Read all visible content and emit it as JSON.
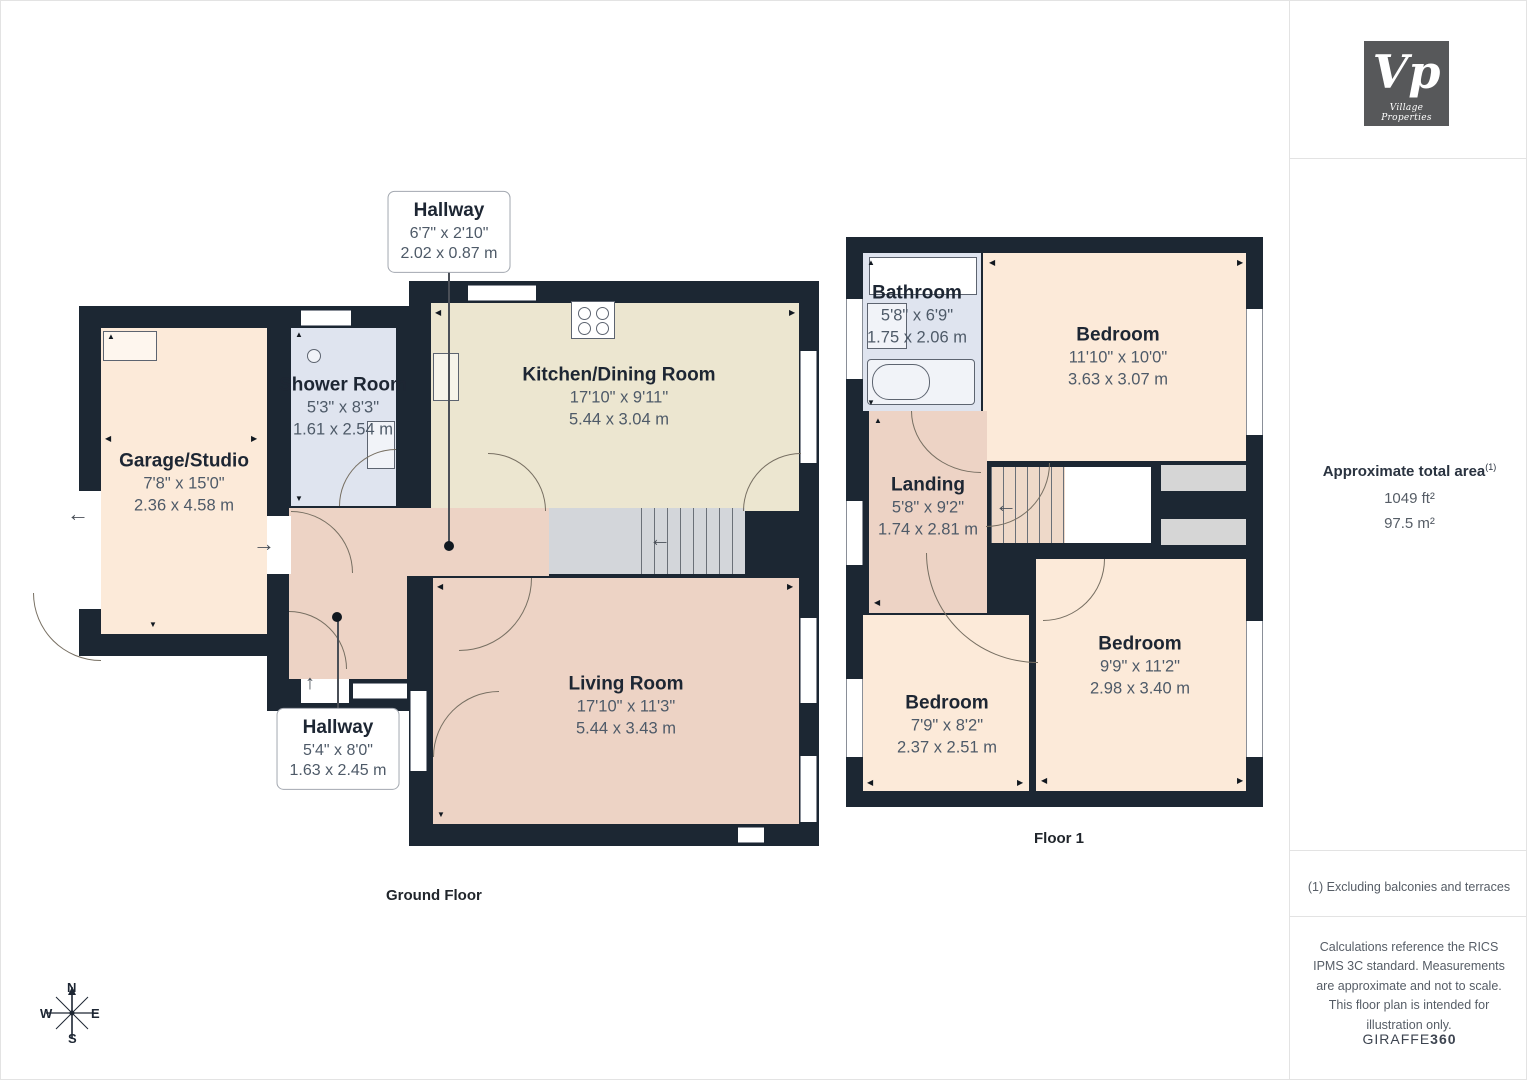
{
  "branding": {
    "logo_text": "Vp",
    "logo_caption": "Village Properties"
  },
  "sidebar": {
    "area_title": "Approximate total area",
    "area_sup": "(1)",
    "area_ft": "1049 ft²",
    "area_m": "97.5 m²",
    "footnote": "(1) Excluding balconies and terraces",
    "disclaimer": "Calculations reference the RICS IPMS 3C standard. Measurements are approximate and not to scale. This floor plan is intended for illustration only.",
    "brand_regular": "GIRAFFE",
    "brand_bold": "360"
  },
  "floors": {
    "ground": {
      "label": "Ground Floor",
      "rooms": [
        {
          "name": "Garage/Studio",
          "dims_imperial": "7'8\" x 15'0\"",
          "dims_metric": "2.36 x 4.58 m"
        },
        {
          "name": "Shower Room",
          "dims_imperial": "5'3\" x 8'3\"",
          "dims_metric": "1.61 x 2.54 m"
        },
        {
          "name": "Kitchen/Dining Room",
          "dims_imperial": "17'10\" x 9'11\"",
          "dims_metric": "5.44 x 3.04 m"
        },
        {
          "name": "Living Room",
          "dims_imperial": "17'10\" x 11'3\"",
          "dims_metric": "5.44 x 3.43 m"
        }
      ],
      "callouts": [
        {
          "name": "Hallway",
          "dims_imperial": "6'7\" x 2'10\"",
          "dims_metric": "2.02 x 0.87 m"
        },
        {
          "name": "Hallway",
          "dims_imperial": "5'4\" x 8'0\"",
          "dims_metric": "1.63 x 2.45 m"
        }
      ]
    },
    "floor1": {
      "label": "Floor 1",
      "rooms": [
        {
          "name": "Bathroom",
          "dims_imperial": "5'8\" x 6'9\"",
          "dims_metric": "1.75 x 2.06 m"
        },
        {
          "name": "Bedroom",
          "dims_imperial": "11'10\" x 10'0\"",
          "dims_metric": "3.63 x 3.07 m"
        },
        {
          "name": "Landing",
          "dims_imperial": "5'8\" x 9'2\"",
          "dims_metric": "1.74 x 2.81 m"
        },
        {
          "name": "Bedroom",
          "dims_imperial": "7'9\" x 8'2\"",
          "dims_metric": "2.37 x 2.51 m"
        },
        {
          "name": "Bedroom",
          "dims_imperial": "9'9\" x 11'2\"",
          "dims_metric": "2.98 x 3.40 m"
        }
      ]
    }
  },
  "compass": {
    "north": "N",
    "south": "S",
    "east": "E",
    "west": "W"
  },
  "colors": {
    "wall": "#1c2733",
    "room_peach": "#fcead9",
    "room_cream": "#ece6d0",
    "room_pink": "#edd3c5",
    "room_blue": "#dfe4ef",
    "stairs_grey": "#d3d6da",
    "logo_bg": "#57585a"
  }
}
